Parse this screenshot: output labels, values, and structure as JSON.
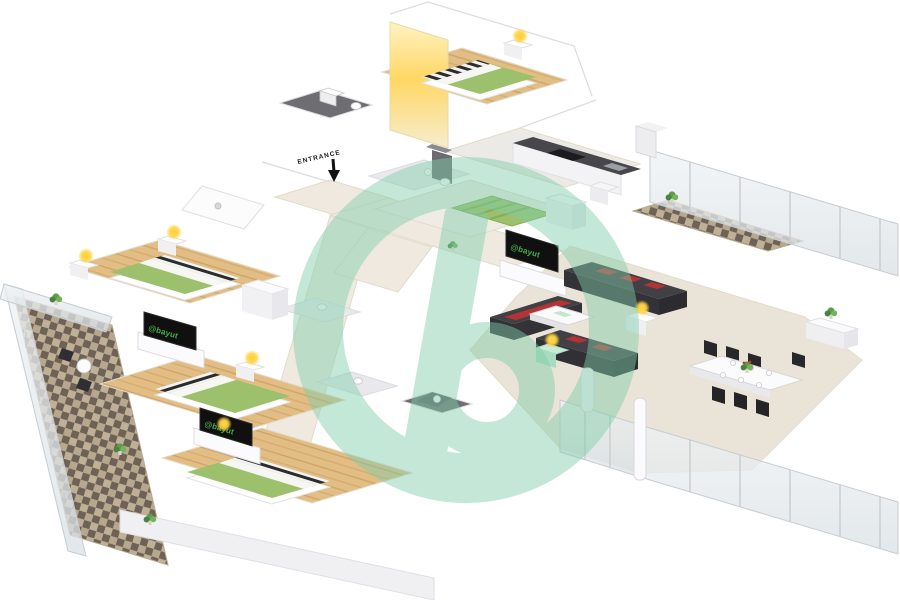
{
  "labels": {
    "entrance": "ENTRANCE"
  },
  "watermark": {
    "logo_text": "@bayut"
  },
  "colors": {
    "wall": "#ffffff",
    "wall_shade": "#f0f0f3",
    "wood": "#e2bd84",
    "floor_beige": "#eae3d7",
    "hall_beige": "#efe9e0",
    "bed_green": "#9cc06b",
    "bed_sheet": "#c3d9a2",
    "sofa_dark": "#404045",
    "cushion_red": "#b23434",
    "lamp_yellow": "#ffd23e",
    "counter_dark": "#47474b",
    "appliance_black": "#1c1c1e",
    "bath_floor_dark": "#6e6e72",
    "tile_dark": "#6e6257",
    "tile_light": "#cdbfa6",
    "glass": "#e4eaee",
    "railing_frame": "#c7ccd0",
    "watermark_teal": "#7fcdaa",
    "logo_green": "#3fae49",
    "tv_black": "#101011",
    "plant_green": "#5f9c4a"
  }
}
